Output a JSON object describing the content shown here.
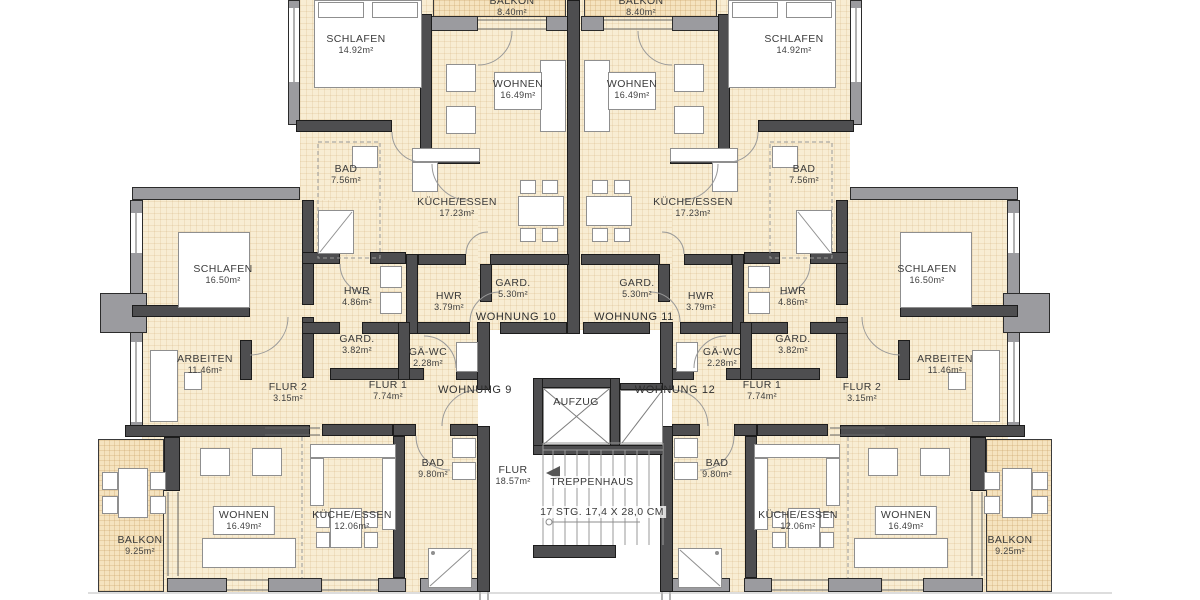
{
  "colors": {
    "background": "#ffffff",
    "floor": "#f8edd3",
    "balcony_floor": "#f5e3bf",
    "wall_interior": "#4e4e50",
    "wall_exterior": "#9b9b9f",
    "text": "#3a3a3a"
  },
  "unit_labels": [
    {
      "id": "wohnung-9",
      "text": "WOHNUNG 9"
    },
    {
      "id": "wohnung-10",
      "text": "WOHNUNG 10"
    },
    {
      "id": "wohnung-11",
      "text": "WOHNUNG 11"
    },
    {
      "id": "wohnung-12",
      "text": "WOHNUNG 12"
    }
  ],
  "rooms": [
    {
      "id": "balkon-10",
      "unit": "WOHNUNG 10",
      "name": "BALKON",
      "area": "8.40m²"
    },
    {
      "id": "schlafen-10",
      "unit": "WOHNUNG 10",
      "name": "SCHLAFEN",
      "area": "14.92m²"
    },
    {
      "id": "wohnen-10",
      "unit": "WOHNUNG 10",
      "name": "WOHNEN",
      "area": "16.49m²"
    },
    {
      "id": "bad-10",
      "unit": "WOHNUNG 10",
      "name": "BAD",
      "area": "7.56m²"
    },
    {
      "id": "kueche-10",
      "unit": "WOHNUNG 10",
      "name": "KÜCHE/ESSEN",
      "area": "17.23m²"
    },
    {
      "id": "gard-10",
      "unit": "WOHNUNG 10",
      "name": "GARD.",
      "area": "5.30m²"
    },
    {
      "id": "hwr-10",
      "unit": "WOHNUNG 10",
      "name": "HWR",
      "area": "3.79m²"
    },
    {
      "id": "balkon-11",
      "unit": "WOHNUNG 11",
      "name": "BALKON",
      "area": "8.40m²"
    },
    {
      "id": "schlafen-11",
      "unit": "WOHNUNG 11",
      "name": "SCHLAFEN",
      "area": "14.92m²"
    },
    {
      "id": "wohnen-11",
      "unit": "WOHNUNG 11",
      "name": "WOHNEN",
      "area": "16.49m²"
    },
    {
      "id": "bad-11",
      "unit": "WOHNUNG 11",
      "name": "BAD",
      "area": "7.56m²"
    },
    {
      "id": "kueche-11",
      "unit": "WOHNUNG 11",
      "name": "KÜCHE/ESSEN",
      "area": "17.23m²"
    },
    {
      "id": "gard-11",
      "unit": "WOHNUNG 11",
      "name": "GARD.",
      "area": "5.30m²"
    },
    {
      "id": "hwr-11",
      "unit": "WOHNUNG 11",
      "name": "HWR",
      "area": "3.79m²"
    },
    {
      "id": "schlafen-9",
      "unit": "WOHNUNG 9",
      "name": "SCHLAFEN",
      "area": "16.50m²"
    },
    {
      "id": "arbeiten-9",
      "unit": "WOHNUNG 9",
      "name": "ARBEITEN",
      "area": "11.46m²"
    },
    {
      "id": "hwr-9",
      "unit": "WOHNUNG 9",
      "name": "HWR",
      "area": "4.86m²"
    },
    {
      "id": "gard-9",
      "unit": "WOHNUNG 9",
      "name": "GARD.",
      "area": "3.82m²"
    },
    {
      "id": "gaewc-9",
      "unit": "WOHNUNG 9",
      "name": "GÄ-WC",
      "area": "2.28m²"
    },
    {
      "id": "flur1-9",
      "unit": "WOHNUNG 9",
      "name": "FLUR 1",
      "area": "7.74m²"
    },
    {
      "id": "flur2-9",
      "unit": "WOHNUNG 9",
      "name": "FLUR 2",
      "area": "3.15m²"
    },
    {
      "id": "bad-9",
      "unit": "WOHNUNG 9",
      "name": "BAD",
      "area": "9.80m²"
    },
    {
      "id": "wohnen-9",
      "unit": "WOHNUNG 9",
      "name": "WOHNEN",
      "area": "16.49m²"
    },
    {
      "id": "kueche-9",
      "unit": "WOHNUNG 9",
      "name": "KÜCHE/ESSEN",
      "area": "12.06m²"
    },
    {
      "id": "balkon-9",
      "unit": "WOHNUNG 9",
      "name": "BALKON",
      "area": "9.25m²"
    },
    {
      "id": "schlafen-12",
      "unit": "WOHNUNG 12",
      "name": "SCHLAFEN",
      "area": "16.50m²"
    },
    {
      "id": "arbeiten-12",
      "unit": "WOHNUNG 12",
      "name": "ARBEITEN",
      "area": "11.46m²"
    },
    {
      "id": "hwr-12",
      "unit": "WOHNUNG 12",
      "name": "HWR",
      "area": "4.86m²"
    },
    {
      "id": "gard-12",
      "unit": "WOHNUNG 12",
      "name": "GARD.",
      "area": "3.82m²"
    },
    {
      "id": "gaewc-12",
      "unit": "WOHNUNG 12",
      "name": "GÄ-WC",
      "area": "2.28m²"
    },
    {
      "id": "flur1-12",
      "unit": "WOHNUNG 12",
      "name": "FLUR 1",
      "area": "7.74m²"
    },
    {
      "id": "flur2-12",
      "unit": "WOHNUNG 12",
      "name": "FLUR 2",
      "area": "3.15m²"
    },
    {
      "id": "bad-12",
      "unit": "WOHNUNG 12",
      "name": "BAD",
      "area": "9.80m²"
    },
    {
      "id": "wohnen-12",
      "unit": "WOHNUNG 12",
      "name": "WOHNEN",
      "area": "16.49m²"
    },
    {
      "id": "kueche-12",
      "unit": "WOHNUNG 12",
      "name": "KÜCHE/ESSEN",
      "area": "12.06m²"
    },
    {
      "id": "balkon-12",
      "unit": "WOHNUNG 12",
      "name": "BALKON",
      "area": "9.25m²"
    }
  ],
  "core": {
    "elevator_label": "AUFZUG",
    "stairwell_label": "TREPPENHAUS",
    "stairs_note": "17 STG. 17,4 X 28,0 CM",
    "hall_name": "FLUR",
    "hall_area": "18.57m²"
  }
}
